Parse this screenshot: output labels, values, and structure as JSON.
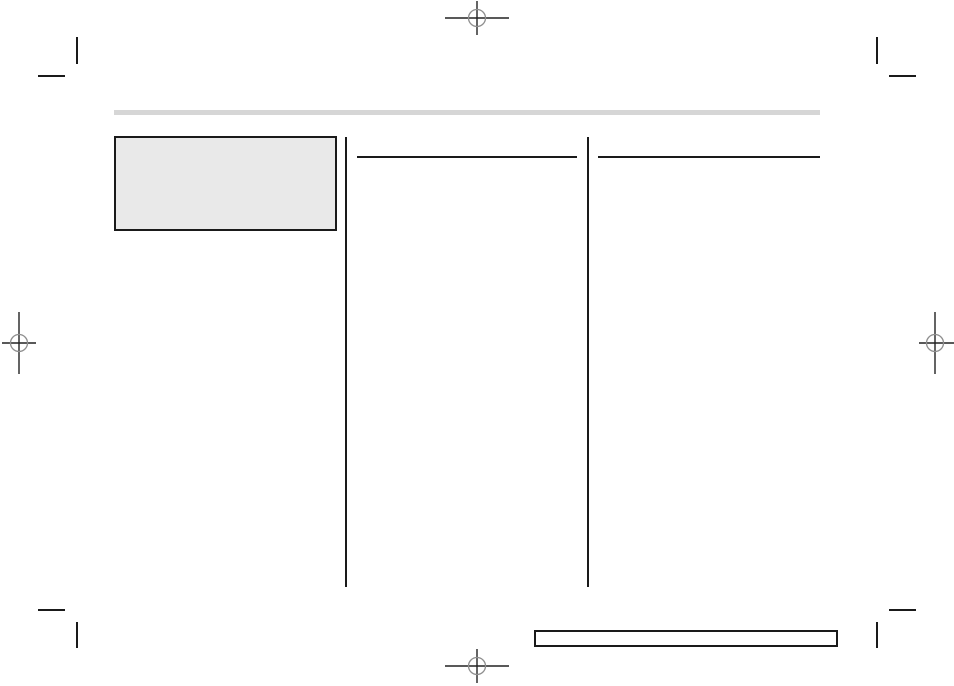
{
  "document": {
    "kind": "blank page proof with printer marks",
    "visible_text": "",
    "background": "#ffffff"
  },
  "colors": {
    "mark_black": "#1a1a1a",
    "crosshair_line": "#222222",
    "registration_circle_gray": "#8f8f8f",
    "header_bar_gray": "#d6d6d6",
    "placeholder_box_fill": "#e9e9e9"
  },
  "printer_marks": {
    "crop_marks": [
      "top-left",
      "top-right",
      "bottom-left",
      "bottom-right"
    ],
    "registration_marks": [
      "top-center",
      "left-middle",
      "right-middle",
      "bottom-center"
    ]
  },
  "layout_regions": {
    "header_bar": "",
    "placeholder_box": "",
    "left_column": "",
    "right_column": "",
    "footer_box": ""
  }
}
